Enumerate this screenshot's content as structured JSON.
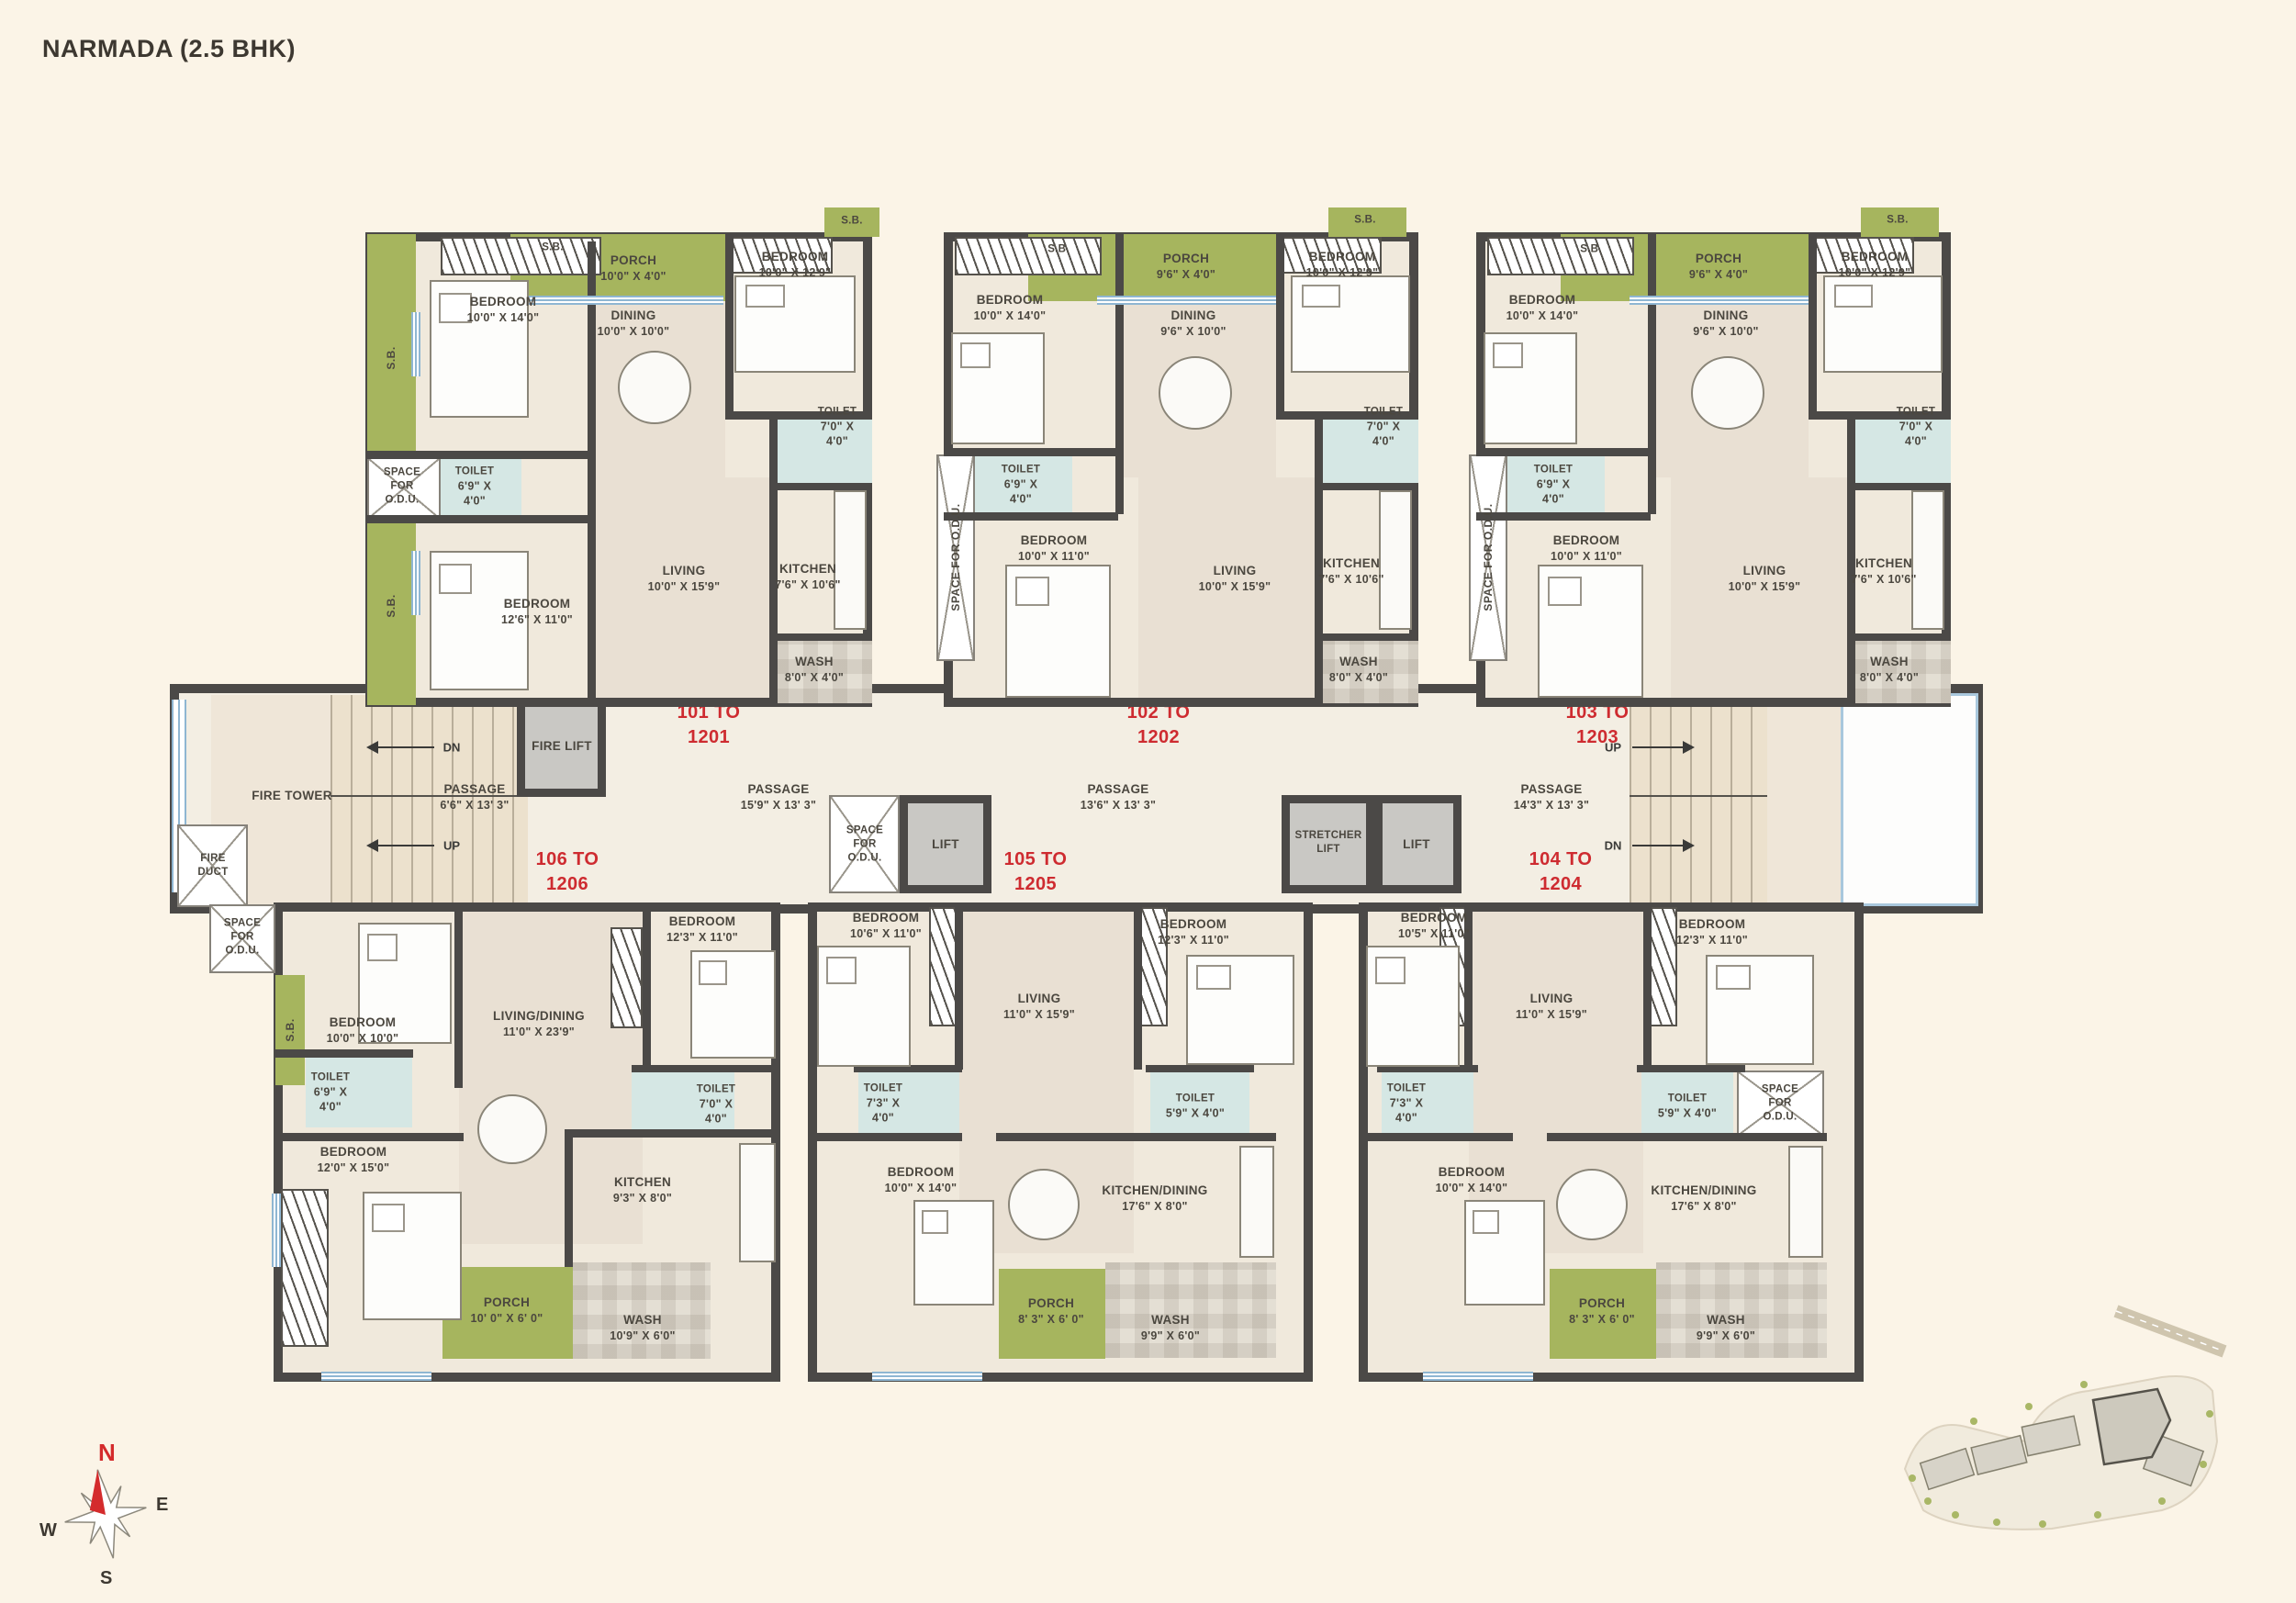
{
  "title": "NARMADA (2.5 BHK)",
  "sb_label": "S.B.",
  "colors": {
    "accent_red": "#ce2b30",
    "wall": "#4b4947",
    "green": "#a6b55e",
    "toilet_blue": "#d5e7e4",
    "background": "#fbf4e7"
  },
  "compass": {
    "n": "N",
    "e": "E",
    "s": "S",
    "w": "W"
  },
  "corridor": {
    "fire_tower": "FIRE TOWER",
    "fire_duct": {
      "l1": "FIRE",
      "l2": "DUCT"
    },
    "fire_lift": "FIRE LIFT",
    "lift_left": "LIFT",
    "lift_right": "LIFT",
    "stretcher_lift": {
      "l1": "STRETCHER",
      "l2": "LIFT"
    },
    "space_odu": {
      "l1": "SPACE",
      "l2": "FOR",
      "l3": "O.D.U."
    },
    "up": "UP",
    "dn": "DN",
    "passage_1": {
      "n": "PASSAGE",
      "d": "6'6\" X 13' 3\""
    },
    "passage_2": {
      "n": "PASSAGE",
      "d": "15'9\" X 13' 3\""
    },
    "passage_3": {
      "n": "PASSAGE",
      "d": "13'6\" X 13' 3\""
    },
    "passage_4": {
      "n": "PASSAGE",
      "d": "14'3\" X 13' 3\""
    },
    "range_101": {
      "l1": "101 TO",
      "l2": "1201"
    },
    "range_102": {
      "l1": "102 TO",
      "l2": "1202"
    },
    "range_103": {
      "l1": "103 TO",
      "l2": "1203"
    },
    "range_104": {
      "l1": "104 TO",
      "l2": "1204"
    },
    "range_105": {
      "l1": "105 TO",
      "l2": "1205"
    },
    "range_106": {
      "l1": "106 TO",
      "l2": "1206"
    }
  },
  "units": {
    "u101": {
      "bed1": {
        "n": "BEDROOM",
        "d": "10'0\" X 14'0\""
      },
      "porch": {
        "n": "PORCH",
        "d": "10'0\" X 4'0\""
      },
      "bed2": {
        "n": "BEDROOM",
        "d": "10'0\" X 12'9\""
      },
      "dining": {
        "n": "DINING",
        "d": "10'0\" X 10'0\""
      },
      "toilet_r": {
        "n": "TOILET",
        "d": "7'0\" X",
        "d2": "4'0\""
      },
      "toilet_l": {
        "n": "TOILET",
        "d": "6'9\" X",
        "d2": "4'0\""
      },
      "odu": {
        "l1": "SPACE",
        "l2": "FOR",
        "l3": "O.D.U."
      },
      "bed3": {
        "n": "BEDROOM",
        "d": "12'6\" X 11'0\""
      },
      "living": {
        "n": "LIVING",
        "d": "10'0\" X 15'9\""
      },
      "kitchen": {
        "n": "KITCHEN",
        "d": "7'6\" X 10'6\""
      },
      "wash": {
        "n": "WASH",
        "d": "8'0\" X 4'0\""
      }
    },
    "u102": {
      "bed1": {
        "n": "BEDROOM",
        "d": "10'0\" X 14'0\""
      },
      "porch": {
        "n": "PORCH",
        "d": "9'6\" X 4'0\""
      },
      "bed2": {
        "n": "BEDROOM",
        "d": "10'0\" X 12'9\""
      },
      "dining": {
        "n": "DINING",
        "d": "9'6\" X 10'0\""
      },
      "toilet_r": {
        "n": "TOILET",
        "d": "7'0\" X",
        "d2": "4'0\""
      },
      "toilet_l": {
        "n": "TOILET",
        "d": "6'9\" X",
        "d2": "4'0\""
      },
      "odu_vertical": "SPACE FOR O.D.U.",
      "bed3": {
        "n": "BEDROOM",
        "d": "10'0\" X 11'0\""
      },
      "living": {
        "n": "LIVING",
        "d": "10'0\" X 15'9\""
      },
      "kitchen": {
        "n": "KITCHEN",
        "d": "7'6\" X 10'6\""
      },
      "wash": {
        "n": "WASH",
        "d": "8'0\" X 4'0\""
      }
    },
    "u103": {
      "bed1": {
        "n": "BEDROOM",
        "d": "10'0\" X 14'0\""
      },
      "porch": {
        "n": "PORCH",
        "d": "9'6\" X 4'0\""
      },
      "bed2": {
        "n": "BEDROOM",
        "d": "10'0\" X 12'9\""
      },
      "dining": {
        "n": "DINING",
        "d": "9'6\" X 10'0\""
      },
      "toilet_r": {
        "n": "TOILET",
        "d": "7'0\" X",
        "d2": "4'0\""
      },
      "toilet_l": {
        "n": "TOILET",
        "d": "6'9\" X",
        "d2": "4'0\""
      },
      "odu_vertical": "SPACE FOR O.D.U.",
      "bed3": {
        "n": "BEDROOM",
        "d": "10'0\" X 11'0\""
      },
      "living": {
        "n": "LIVING",
        "d": "10'0\" X 15'9\""
      },
      "kitchen": {
        "n": "KITCHEN",
        "d": "7'6\" X 10'6\""
      },
      "wash": {
        "n": "WASH",
        "d": "8'0\" X 4'0\""
      }
    },
    "u106": {
      "odu": {
        "l1": "SPACE",
        "l2": "FOR",
        "l3": "O.D.U."
      },
      "bed1": {
        "n": "BEDROOM",
        "d": "10'0\" X 10'0\""
      },
      "living_dining": {
        "n": "LIVING/DINING",
        "d": "11'0\" X 23'9\""
      },
      "bed2": {
        "n": "BEDROOM",
        "d": "12'3\" X 11'0\""
      },
      "toilet_l": {
        "n": "TOILET",
        "d": "6'9\" X",
        "d2": "4'0\""
      },
      "toilet_r": {
        "n": "TOILET",
        "d": "7'0\" X",
        "d2": "4'0\""
      },
      "bed3": {
        "n": "BEDROOM",
        "d": "12'0\" X 15'0\""
      },
      "kitchen": {
        "n": "KITCHEN",
        "d": "9'3\" X 8'0\""
      },
      "porch": {
        "n": "PORCH",
        "d": "10' 0\" X 6' 0\""
      },
      "wash": {
        "n": "WASH",
        "d": "10'9\" X 6'0\""
      }
    },
    "u105": {
      "bed1": {
        "n": "BEDROOM",
        "d": "10'6\" X 11'0\""
      },
      "living": {
        "n": "LIVING",
        "d": "11'0\" X 15'9\""
      },
      "bed2": {
        "n": "BEDROOM",
        "d": "12'3\" X 11'0\""
      },
      "toilet_l": {
        "n": "TOILET",
        "d": "7'3\" X",
        "d2": "4'0\""
      },
      "toilet_r": {
        "n": "TOILET",
        "d": "5'9\" X 4'0\""
      },
      "bed3": {
        "n": "BEDROOM",
        "d": "10'0\" X 14'0\""
      },
      "kitchen_dining": {
        "n": "KITCHEN/DINING",
        "d": "17'6\" X 8'0\""
      },
      "porch": {
        "n": "PORCH",
        "d": "8' 3\" X 6' 0\""
      },
      "wash": {
        "n": "WASH",
        "d": "9'9\" X 6'0\""
      }
    },
    "u104": {
      "bed1": {
        "n": "BEDROOM",
        "d": "10'5\" X 11'0\""
      },
      "living": {
        "n": "LIVING",
        "d": "11'0\" X 15'9\""
      },
      "bed2": {
        "n": "BEDROOM",
        "d": "12'3\" X 11'0\""
      },
      "toilet_l": {
        "n": "TOILET",
        "d": "7'3\" X",
        "d2": "4'0\""
      },
      "toilet_r": {
        "n": "TOILET",
        "d": "5'9\" X 4'0\""
      },
      "odu": {
        "l1": "SPACE",
        "l2": "FOR",
        "l3": "O.D.U."
      },
      "bed3": {
        "n": "BEDROOM",
        "d": "10'0\" X 14'0\""
      },
      "kitchen_dining": {
        "n": "KITCHEN/DINING",
        "d": "17'6\" X 8'0\""
      },
      "porch": {
        "n": "PORCH",
        "d": "8' 3\" X 6' 0\""
      },
      "wash": {
        "n": "WASH",
        "d": "9'9\" X 6'0\""
      }
    }
  }
}
